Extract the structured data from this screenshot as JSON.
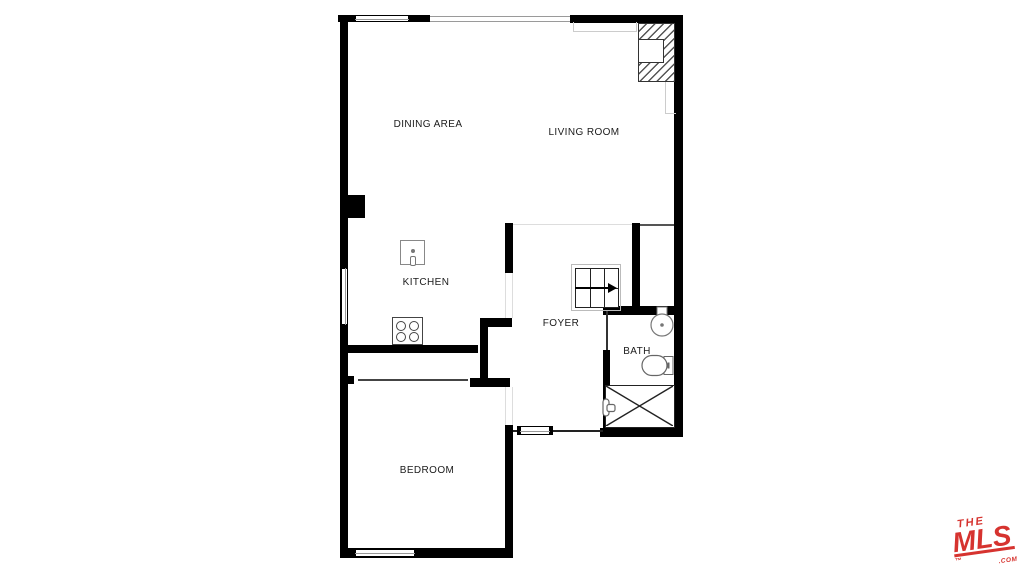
{
  "canvas": {
    "width": 1024,
    "height": 576,
    "background": "#ffffff"
  },
  "floorplan": {
    "rooms": [
      {
        "name": "dining-area",
        "label": "DINING AREA"
      },
      {
        "name": "living-room",
        "label": "LIVING ROOM"
      },
      {
        "name": "kitchen",
        "label": "KITCHEN"
      },
      {
        "name": "foyer",
        "label": "FOYER"
      },
      {
        "name": "bath",
        "label": "BATH"
      },
      {
        "name": "bedroom",
        "label": "BEDROOM"
      }
    ],
    "fixtures": [
      "fireplace",
      "stairs",
      "kitchen-sink",
      "stove",
      "pedestal-sink",
      "toilet",
      "shower",
      "shower-valve"
    ],
    "colors": {
      "wall": "#000000",
      "fixture_outline": "#666666",
      "faint_line": "#cccccc",
      "label": "#1b1b1b"
    }
  },
  "logo": {
    "line1": "THE",
    "line2": "MLS",
    "trademark": "™",
    "suffix": ".COM",
    "color": "#d6332f"
  }
}
